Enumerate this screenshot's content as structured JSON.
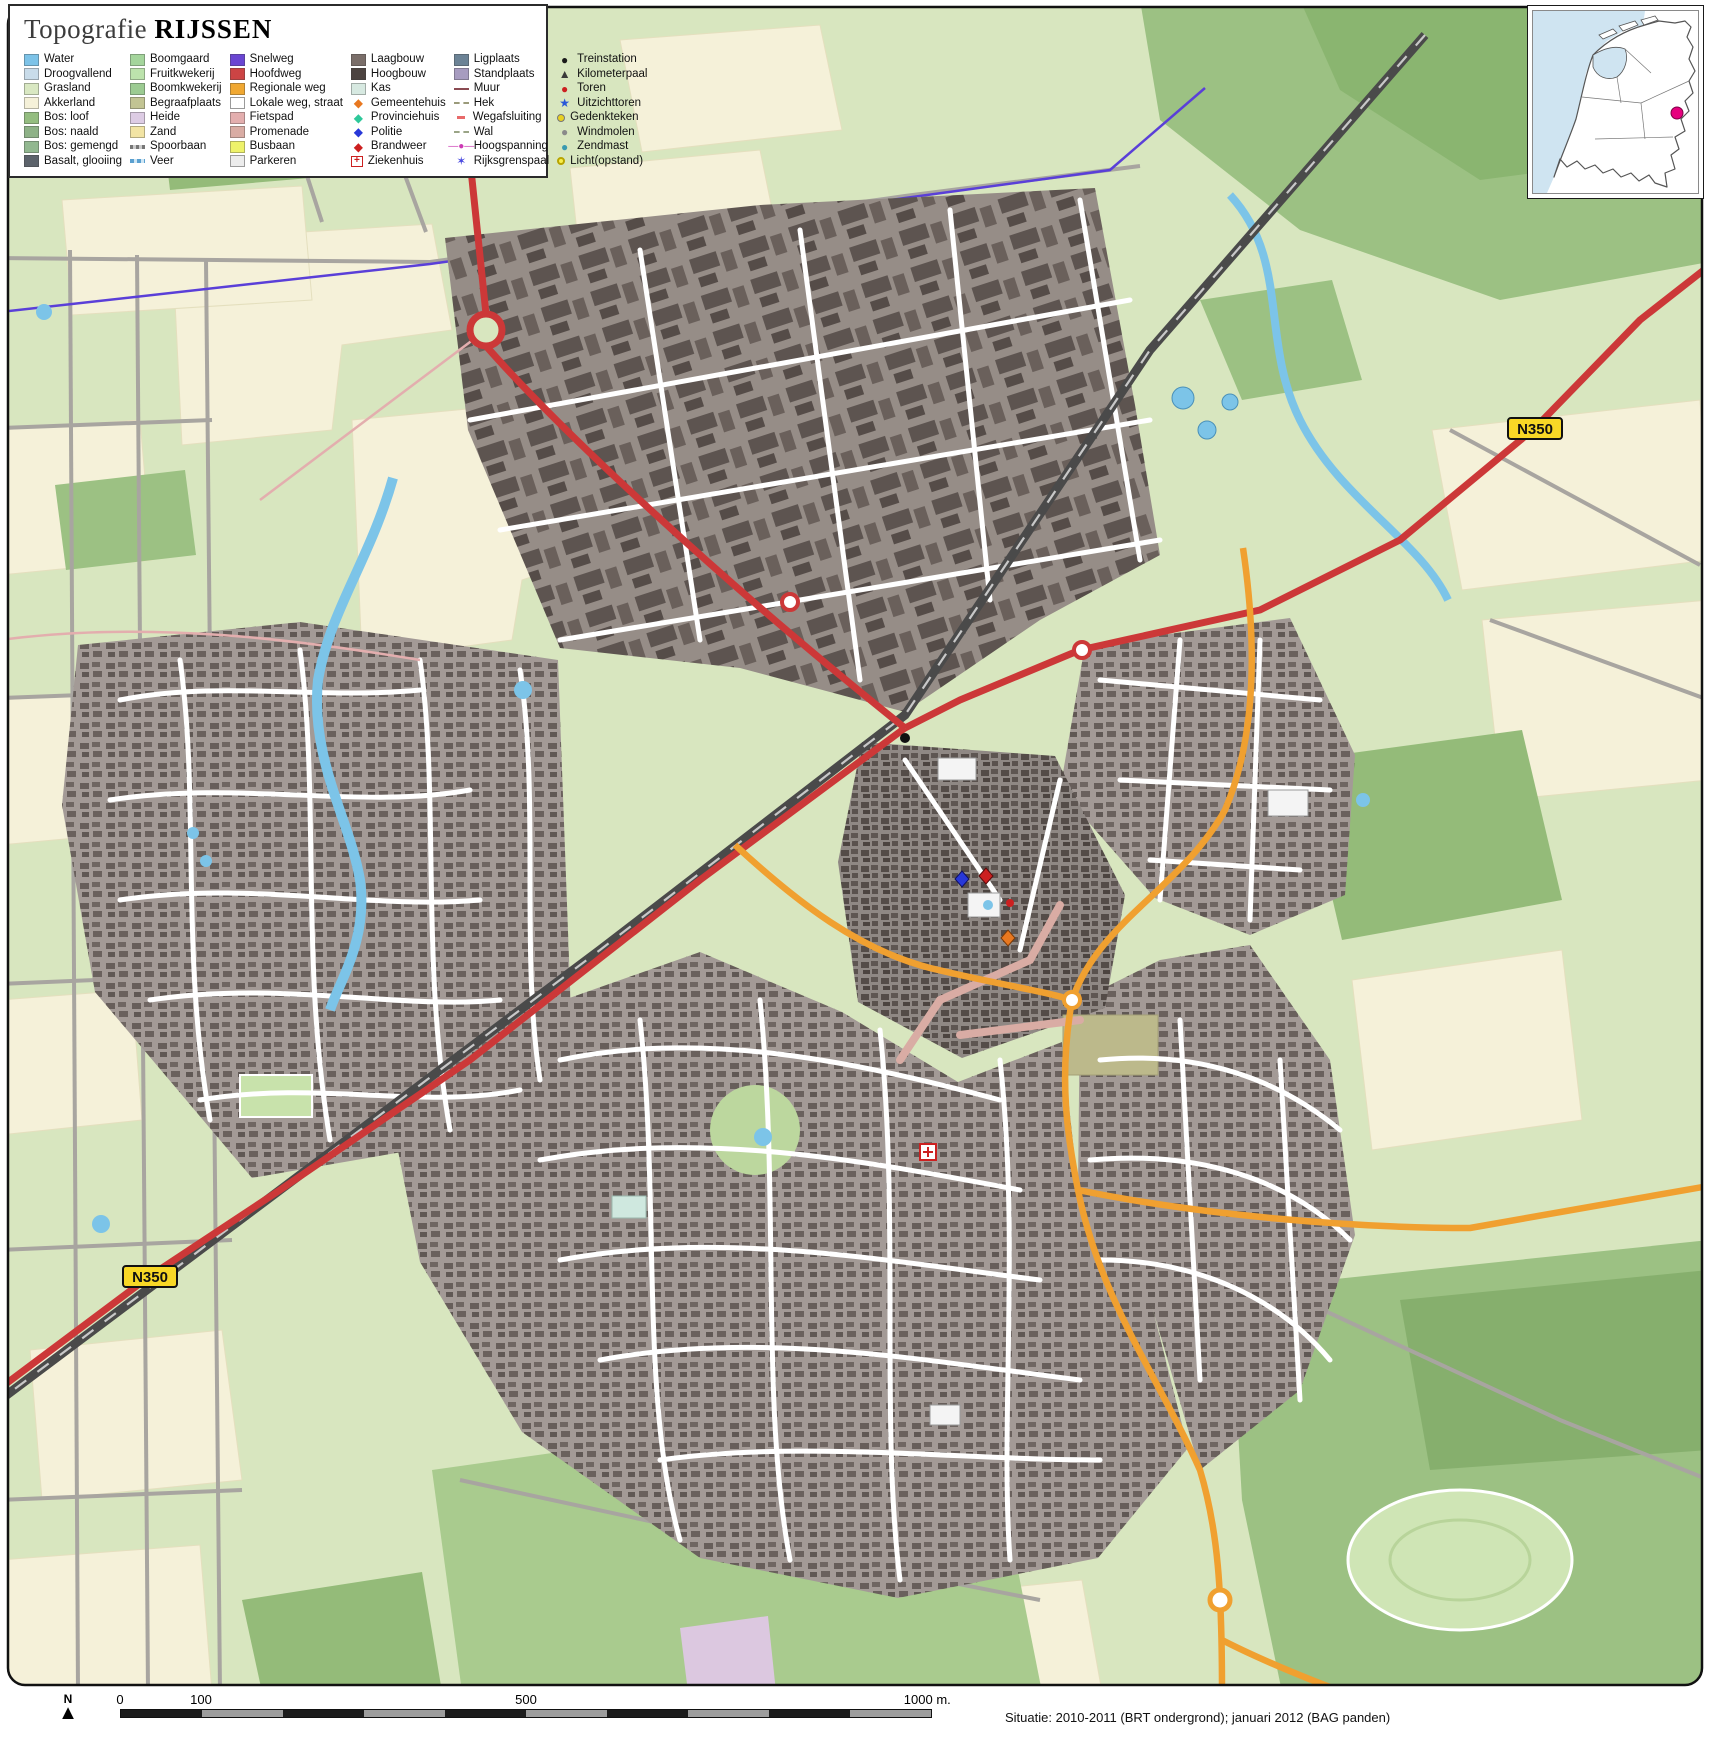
{
  "title": {
    "prefix": "Topografie",
    "name": "RIJSSEN"
  },
  "map": {
    "road_badge": "N350"
  },
  "inset": {
    "marker_color": "#e6007e"
  },
  "north_label": "N",
  "scalebar": {
    "labels": {
      "t0": "0",
      "t100": "100",
      "t500": "500",
      "t1000": "1000 m."
    }
  },
  "attribution": "Situatie: 2010-2011 (BRT ondergrond); januari 2012 (BAG panden)",
  "legend": {
    "columns": [
      [
        {
          "t": "rect",
          "c": "#7dc3e8",
          "label": "Water"
        },
        {
          "t": "rect",
          "c": "#c9dcea",
          "label": "Droogvallend"
        },
        {
          "t": "rect",
          "c": "#d9e8c2",
          "label": "Grasland"
        },
        {
          "t": "rect",
          "c": "#f5f1d9",
          "label": "Akkerland"
        },
        {
          "t": "rect",
          "c": "#94bd80",
          "label": "Bos: loof"
        },
        {
          "t": "rect",
          "c": "#8eb287",
          "label": "Bos: naald"
        },
        {
          "t": "rect",
          "c": "#92b890",
          "label": "Bos: gemengd"
        },
        {
          "t": "rect",
          "c": "#5c636b",
          "label": "Basalt, glooiing"
        }
      ],
      [
        {
          "t": "rect",
          "c": "#a4d59c",
          "label": "Boomgaard"
        },
        {
          "t": "rect",
          "c": "#bce3ac",
          "label": "Fruitkwekerij"
        },
        {
          "t": "rect",
          "c": "#9ccb92",
          "label": "Boomkwekerij"
        },
        {
          "t": "rect",
          "c": "#c2c493",
          "label": "Begraafplaats"
        },
        {
          "t": "rect",
          "c": "#ddcce4",
          "label": "Heide"
        },
        {
          "t": "rect",
          "c": "#f2e4a4",
          "label": "Zand"
        },
        {
          "t": "rail",
          "c": "#8a8a8a",
          "label": "Spoorbaan"
        },
        {
          "t": "veer",
          "c": "#5aa0d0",
          "label": "Veer"
        }
      ],
      [
        {
          "t": "rect",
          "c": "#6a46d2",
          "label": "Snelweg"
        },
        {
          "t": "rect",
          "c": "#cc4444",
          "label": "Hoofdweg"
        },
        {
          "t": "rect",
          "c": "#f0a832",
          "label": "Regionale weg"
        },
        {
          "t": "rect-border",
          "c": "#ffffff",
          "label": "Lokale weg, straat"
        },
        {
          "t": "rect",
          "c": "#e3aeae",
          "label": "Fietspad"
        },
        {
          "t": "rect",
          "c": "#d9aca4",
          "label": "Promenade"
        },
        {
          "t": "rect",
          "c": "#eef26a",
          "label": "Busbaan"
        },
        {
          "t": "rect-border",
          "c": "#ececec",
          "label": "Parkeren"
        }
      ],
      [
        {
          "t": "rect",
          "c": "#7a6e69",
          "label": "Laagbouw"
        },
        {
          "t": "rect",
          "c": "#4c4340",
          "label": "Hoogbouw"
        },
        {
          "t": "rect",
          "c": "#d7e9e1",
          "label": "Kas"
        },
        {
          "t": "diamond",
          "c": "#e87820",
          "label": "Gemeentehuis"
        },
        {
          "t": "diamond",
          "c": "#2ec89a",
          "label": "Provinciehuis"
        },
        {
          "t": "diamond",
          "c": "#2838d8",
          "label": "Politie"
        },
        {
          "t": "diamond",
          "c": "#cc2020",
          "label": "Brandweer"
        },
        {
          "t": "cross",
          "c": "#cc2020",
          "label": "Ziekenhuis"
        }
      ],
      [
        {
          "t": "rect",
          "c": "#6c8396",
          "label": "Ligplaats"
        },
        {
          "t": "rect",
          "c": "#a79cc0",
          "label": "Standplaats"
        },
        {
          "t": "line",
          "c": "#8a4a52",
          "label": "Muur"
        },
        {
          "t": "hek",
          "c": "#9a9a7a",
          "label": "Hek"
        },
        {
          "t": "dash",
          "c": "#e86a6a",
          "label": "Wegafsluiting"
        },
        {
          "t": "wal",
          "c": "#9aa486",
          "label": "Wal"
        },
        {
          "t": "hoogspanning",
          "c": "#cc3ab4",
          "label": "Hoogspanning"
        },
        {
          "t": "grenspaal",
          "c": "#4a4ae0",
          "label": "Rijksgrenspaal"
        }
      ],
      [
        {
          "t": "dot",
          "c": "#1a1a1a",
          "label": "Treinstation"
        },
        {
          "t": "triangle",
          "c": "#3a3a3a",
          "label": "Kilometerpaal"
        },
        {
          "t": "dot",
          "c": "#cc2020",
          "label": "Toren"
        },
        {
          "t": "star",
          "c": "#2858d8",
          "label": "Uitzichttoren"
        },
        {
          "t": "dot-ring",
          "c": "#e8d020",
          "label": "Gedenkteken"
        },
        {
          "t": "dot",
          "c": "#8a8a8a",
          "label": "Windmolen"
        },
        {
          "t": "dot",
          "c": "#3a9ab0",
          "label": "Zendmast"
        },
        {
          "t": "ring",
          "c": "#f0e020",
          "label": "Licht(opstand)"
        }
      ]
    ]
  }
}
